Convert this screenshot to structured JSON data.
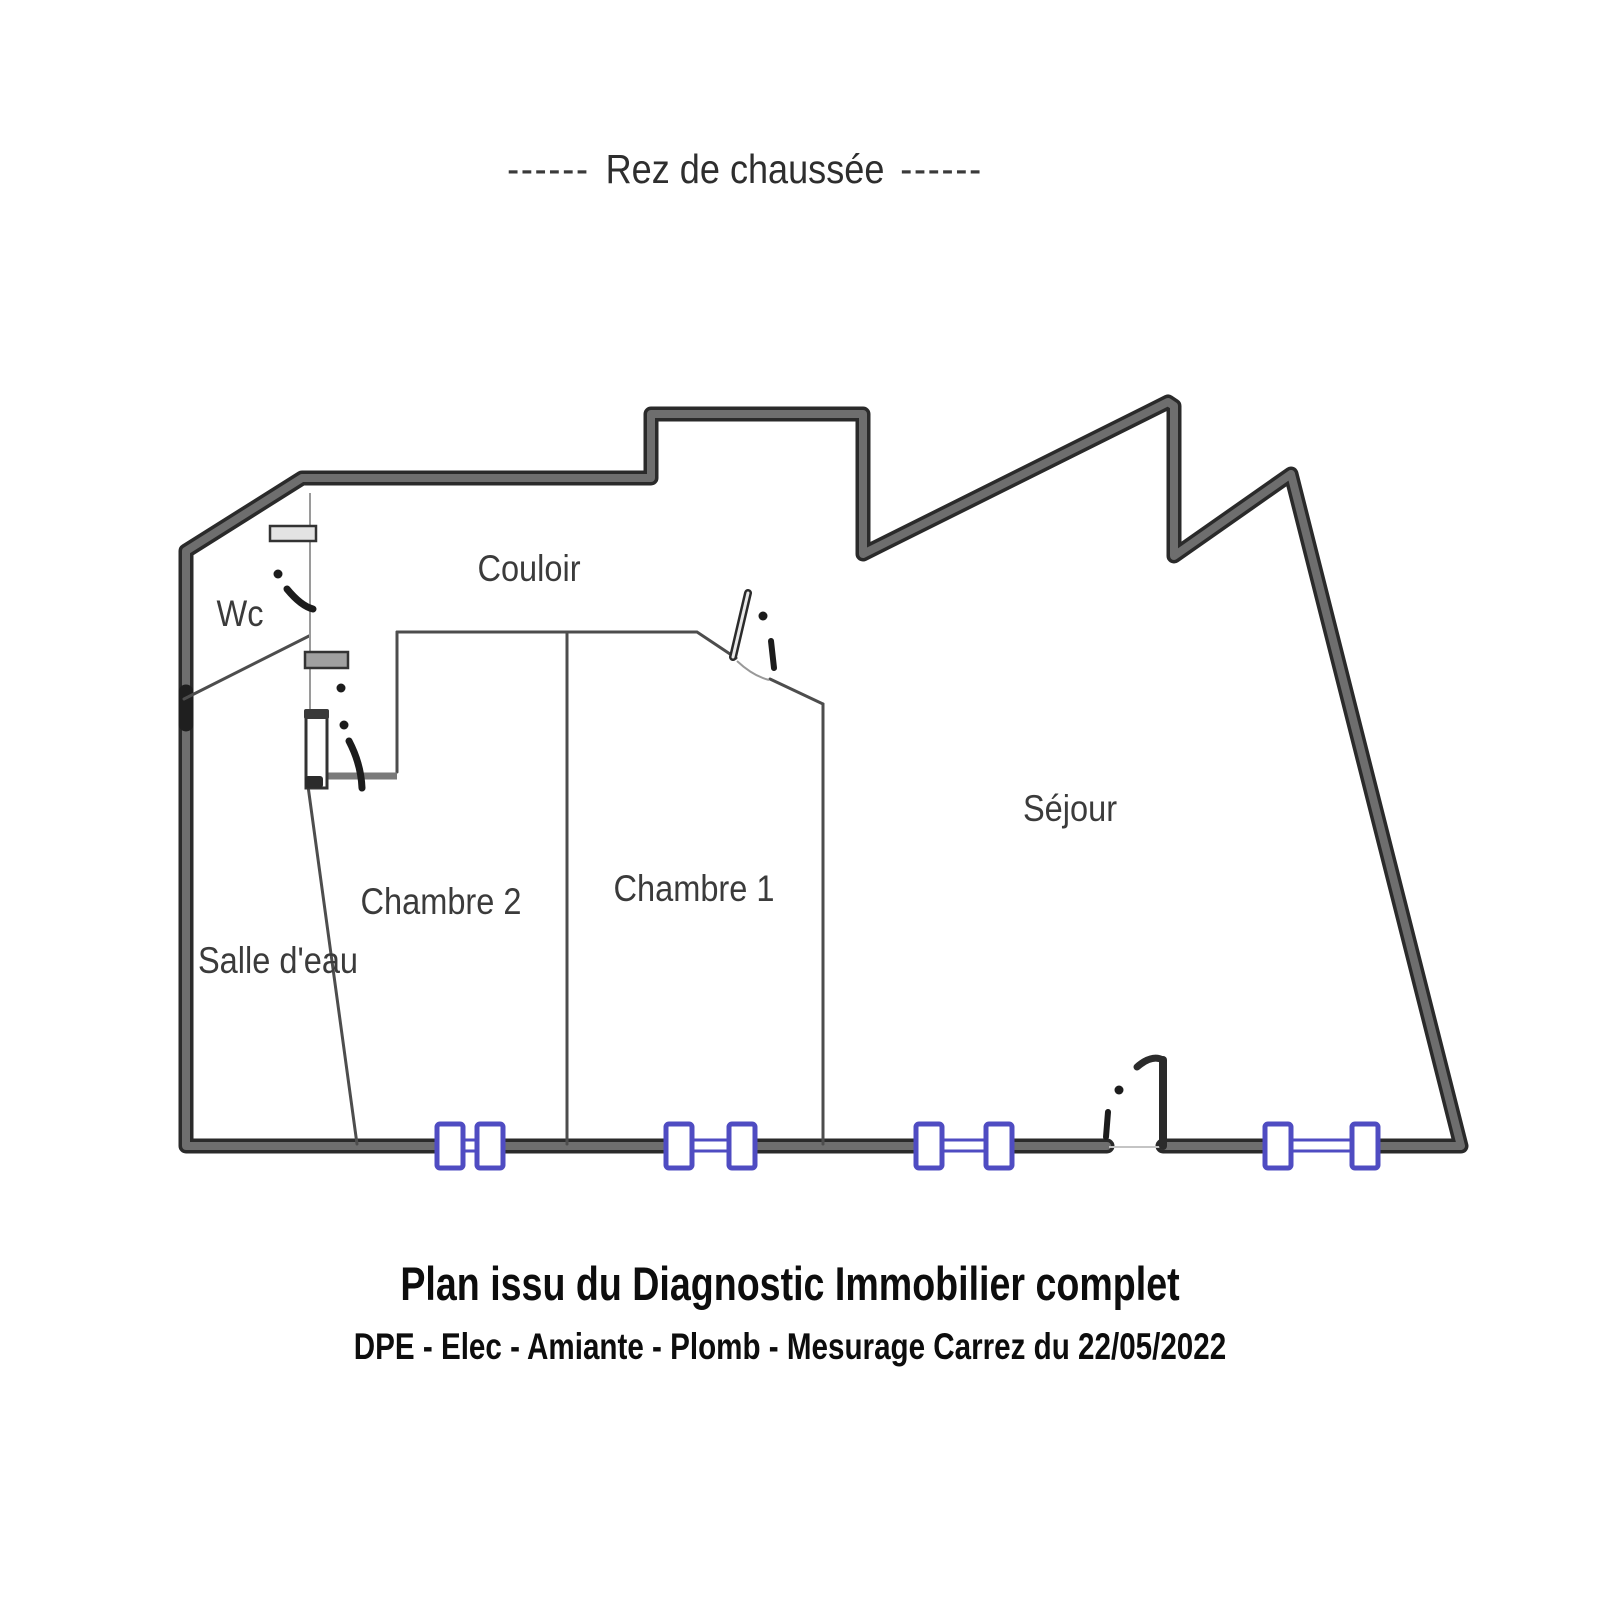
{
  "title": {
    "left_dashes": "------",
    "text": "Rez de chaussée",
    "right_dashes": "------"
  },
  "rooms": {
    "wc": "Wc",
    "couloir": "Couloir",
    "chambre2": "Chambre 2",
    "chambre1": "Chambre 1",
    "sejour": "Séjour",
    "salle_deau": "Salle d'eau"
  },
  "footer": {
    "line1": "Plan issu du Diagnostic Immobilier complet",
    "line2": "DPE - Elec - Amiante - Plomb - Mesurage Carrez du 22/05/2022"
  },
  "colors": {
    "wall_outline": "#2a2a2a",
    "wall_fill": "#6e6e6e",
    "interior_line": "#4d4d4d",
    "window_frame": "#4f4cc2",
    "label_text": "#3b3b3b",
    "door_mark": "#1c1c1c"
  }
}
